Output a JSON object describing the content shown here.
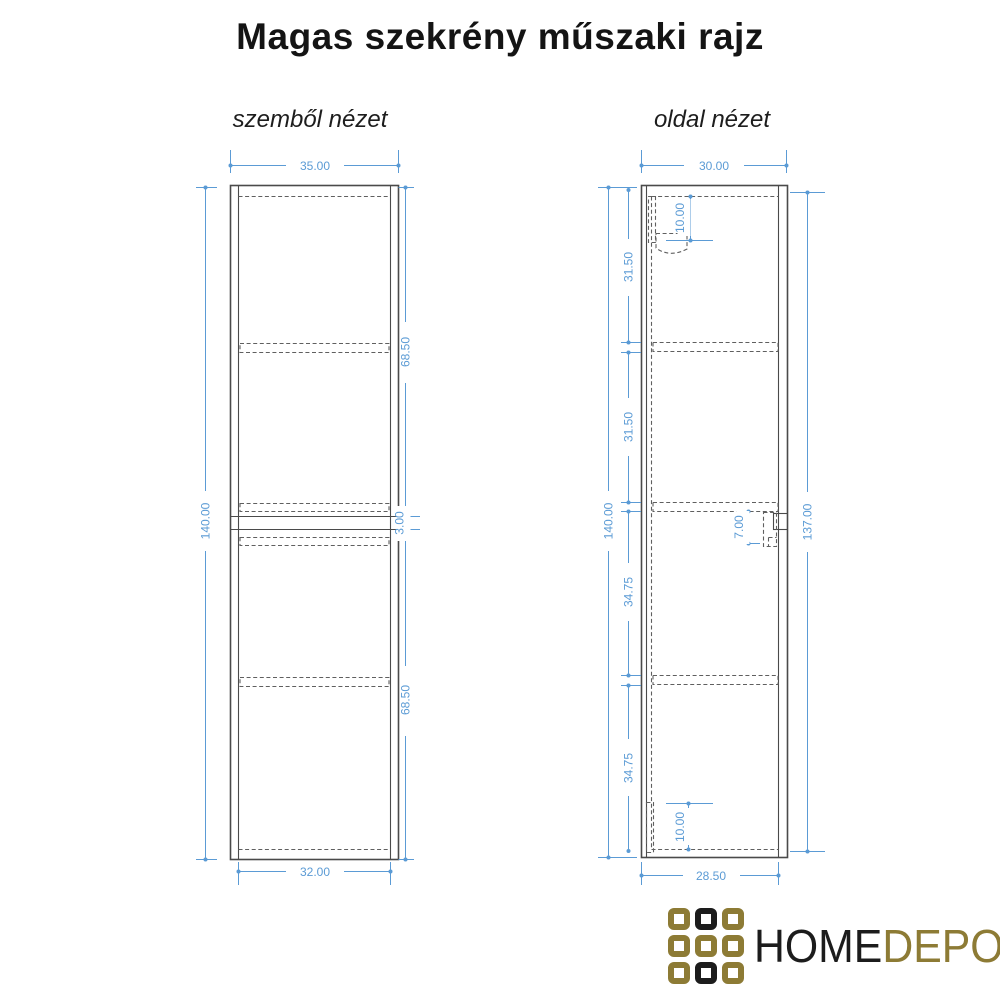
{
  "title": "Magas szekrény műszaki rajz",
  "front_view": {
    "label": "szemből nézet",
    "dims": {
      "width_top": "35.00",
      "width_bottom": "32.00",
      "total_height": "140.00",
      "upper_section": "68.50",
      "middle_gap": "3.00",
      "lower_section": "68.50"
    }
  },
  "side_view": {
    "label": "oldal nézet",
    "dims": {
      "depth_top": "30.00",
      "depth_bottom": "28.50",
      "total_height": "140.00",
      "front_height": "137.00",
      "segment_1": "31.50",
      "segment_2": "31.50",
      "segment_3": "34.75",
      "segment_4": "34.75",
      "top_bracket": "10.00",
      "connector": "7.00",
      "bottom_bracket": "10.00"
    }
  },
  "logo": {
    "home": "HOME",
    "depo": "DEPO",
    "grid": [
      "gold",
      "black",
      "gold",
      "gold",
      "gold",
      "gold",
      "gold",
      "black",
      "gold"
    ]
  },
  "colors": {
    "dim": "#5b9bd5",
    "line": "#4a4a4a",
    "dashline": "#5f5f5f",
    "gold": "#8d7b35",
    "logo_black": "#1c1c1c",
    "title": "#141414"
  }
}
